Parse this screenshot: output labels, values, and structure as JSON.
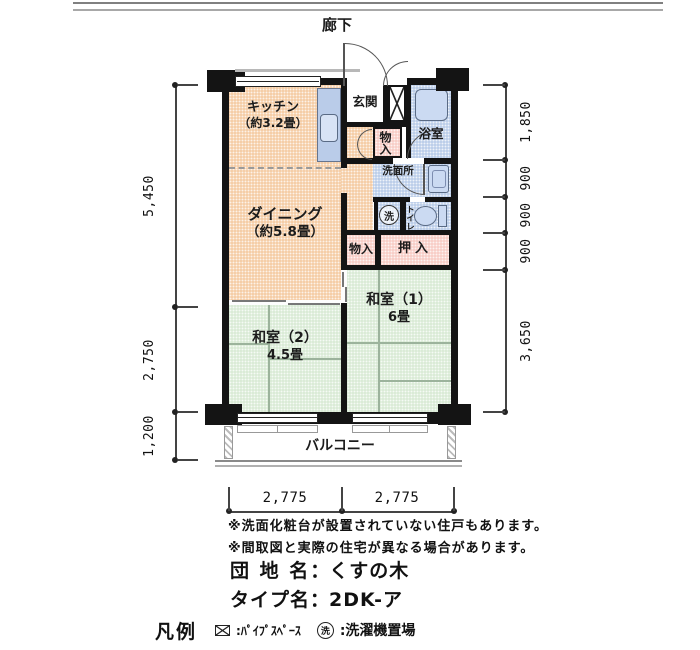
{
  "corridor": {
    "label": "廊下"
  },
  "rooms": {
    "kitchen": {
      "name": "キッチン",
      "size": "（約3.2畳）"
    },
    "dining": {
      "name": "ダイニング",
      "size": "（約5.8畳）"
    },
    "japanese1": {
      "name": "和室（1）",
      "size": "6畳"
    },
    "japanese2": {
      "name": "和室（2）",
      "size": "4.5畳"
    },
    "genkan": {
      "name": "玄関"
    },
    "bath": {
      "name": "浴室"
    },
    "washroom": {
      "name": "洗面所"
    },
    "toilet": {
      "name": "トイレ"
    },
    "closet_entrance": {
      "name": "物入"
    },
    "closet_dining": {
      "name": "物入"
    },
    "oshiire": {
      "name": "押入"
    },
    "laundry": {
      "symbol": "洗"
    },
    "balcony": {
      "name": "バルコニー"
    }
  },
  "dimensions": {
    "left": [
      "5,450",
      "2,750",
      "1,200"
    ],
    "right": [
      "1,850",
      "900",
      "900",
      "900",
      "3,650"
    ],
    "bottom": [
      "2,775",
      "2,775"
    ]
  },
  "notes": [
    "※洗面化粧台が設置されていない住戸もあります。",
    "※間取図と実際の住宅が異なる場合があります。"
  ],
  "title": {
    "estate_label": "団 地 名",
    "estate_colon": "：",
    "estate_value": "くすの木",
    "type_label": "タイプ名",
    "type_colon": "：",
    "type_value": "2DK-ア"
  },
  "legend": {
    "heading": "凡例",
    "pipe_text": ":ﾊﾟｲﾌﾟｽﾍﾟｰｽ",
    "laundry_symbol": "洗",
    "laundry_text": ":洗濯機置場"
  },
  "colors": {
    "room_wood": "#F5CDA6",
    "room_wet": "#BCCEE9",
    "room_closet": "#F8CEC7",
    "room_tatami": "#DAEBD6",
    "wall": "#141414"
  }
}
